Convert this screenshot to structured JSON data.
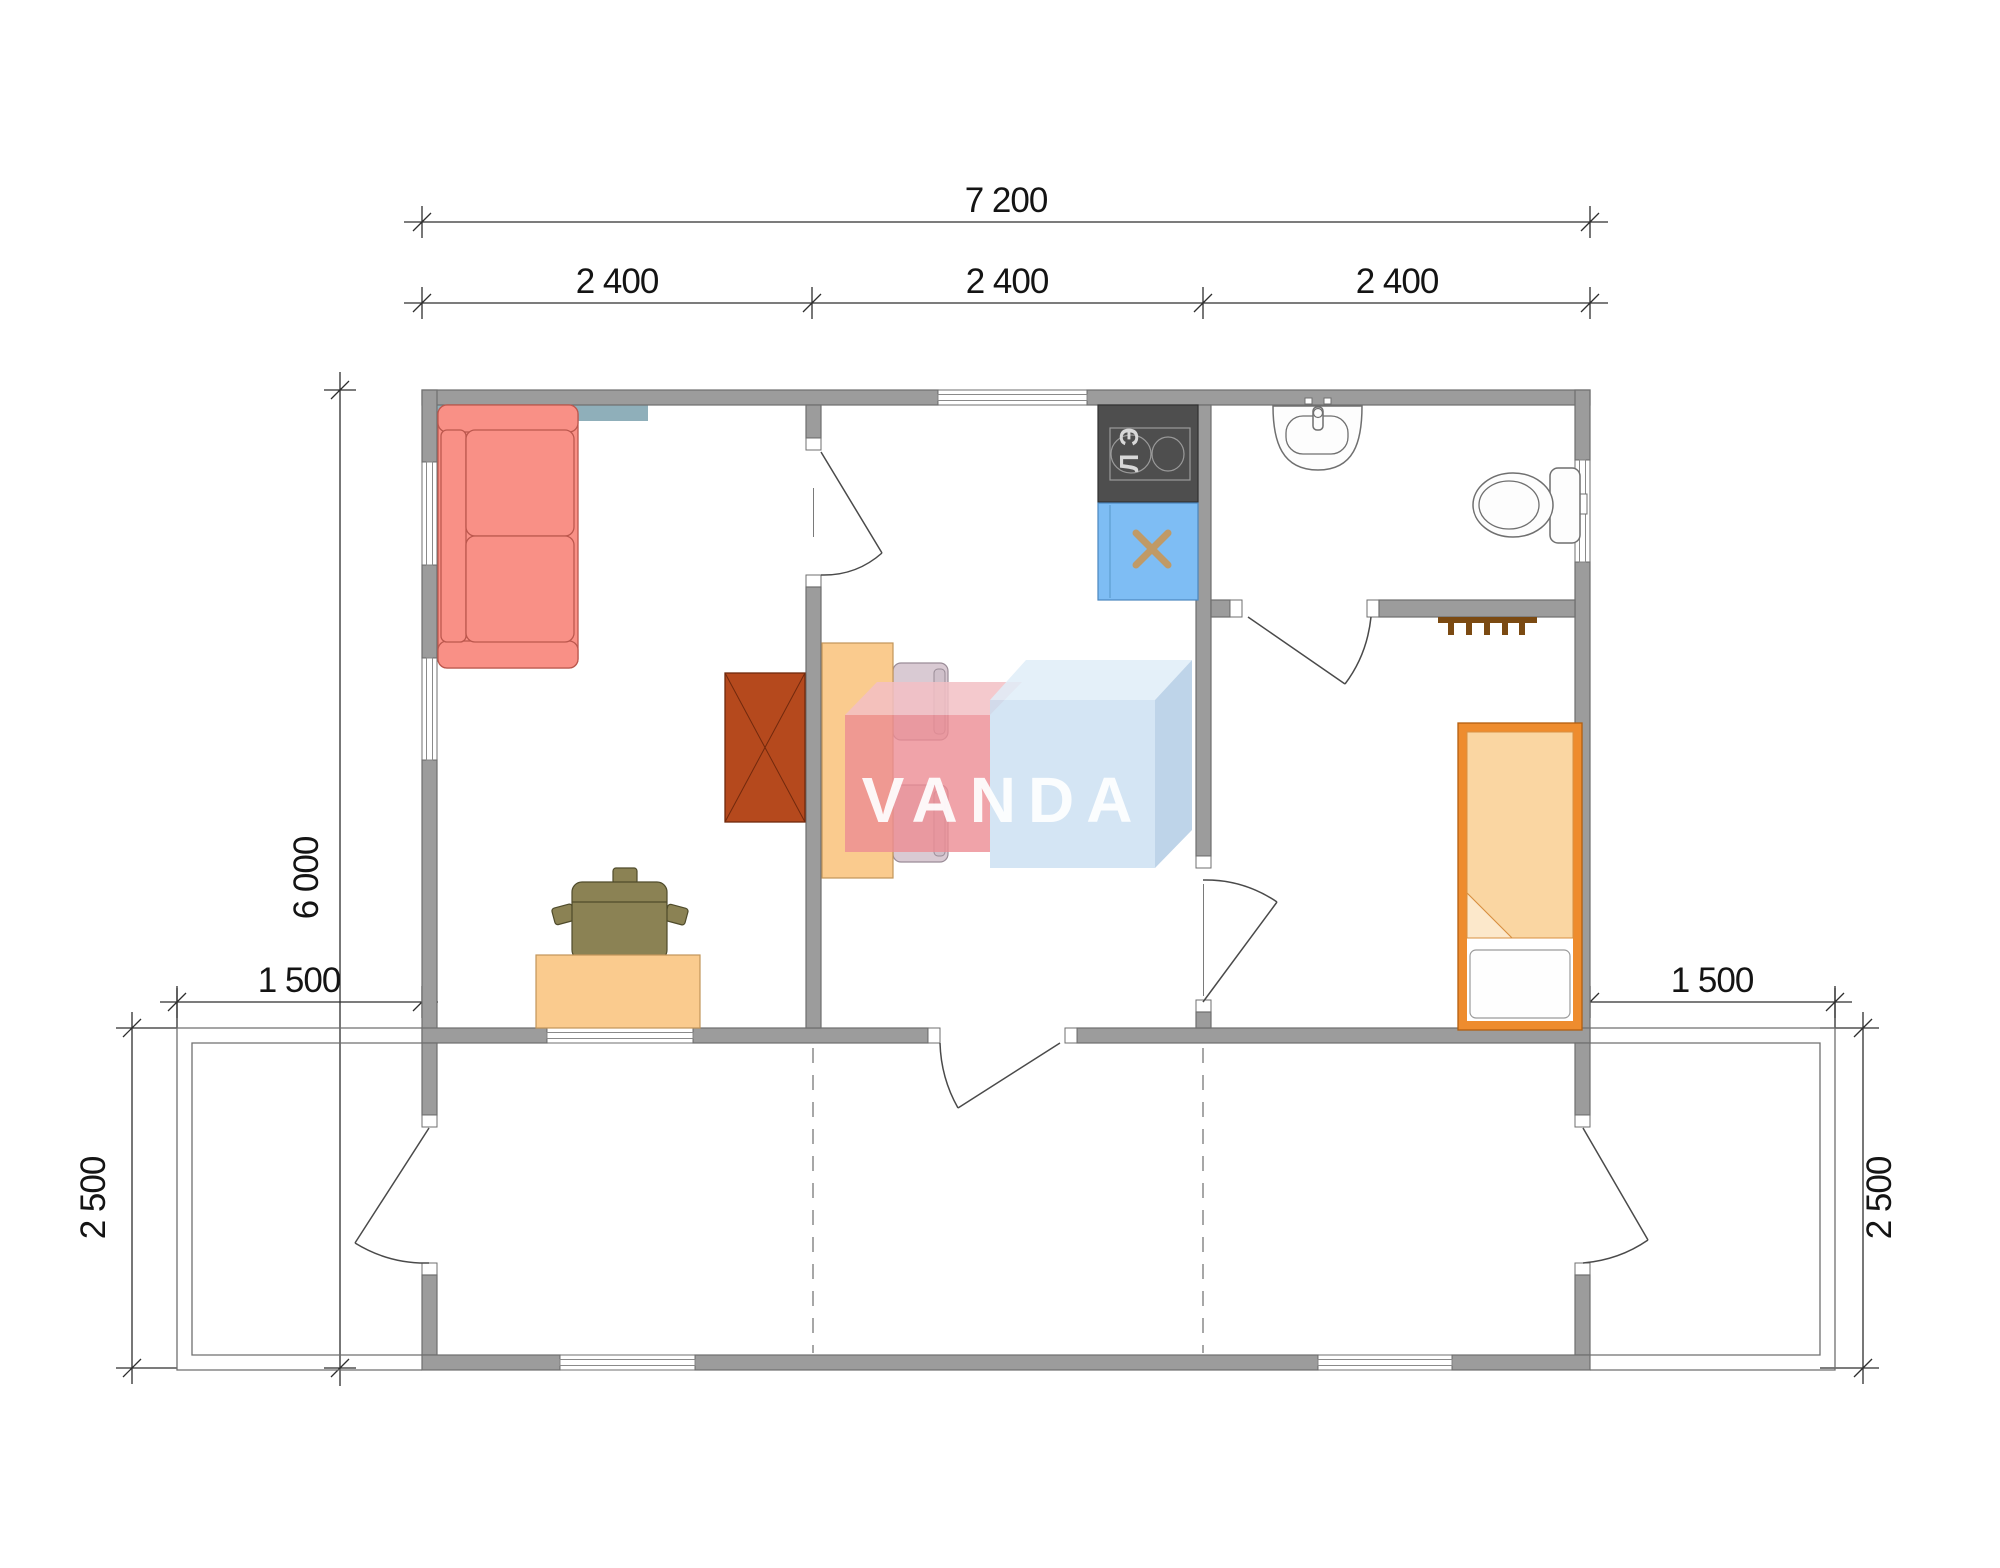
{
  "type": "floor-plan",
  "watermark": {
    "text": "VANDA",
    "pink": "#EC8C93",
    "blue": "#C9DEF1"
  },
  "dimensions": {
    "top_total": "7 200",
    "module_1": "2 400",
    "module_2": "2 400",
    "module_3": "2 400",
    "side_height": "6 000",
    "porch_ext_left": "1 500",
    "porch_ext_right": "1 500",
    "porch_depth_left": "2 500",
    "porch_depth_right": "2 500"
  },
  "labels": {
    "stove": "ЭЛ"
  },
  "colors": {
    "wall": "#9C9C9C",
    "wall_outline": "#6F6F6F",
    "sofa": "#F99086",
    "wardrobe": "#B5491D",
    "table": "#FACB8E",
    "desk": "#FACB8E",
    "dining_chair": "#D9CAD3",
    "desk_chair": "#8B8254",
    "bed_frame": "#EE8C2E",
    "blanket": "#FAD6A2",
    "kitchen_sink": "#7EBDF4",
    "stove": "#4E4E4E",
    "accent_teal": "#8FAFBA",
    "hooks": "#7B4A12",
    "sink_cross": "#C09A66"
  }
}
